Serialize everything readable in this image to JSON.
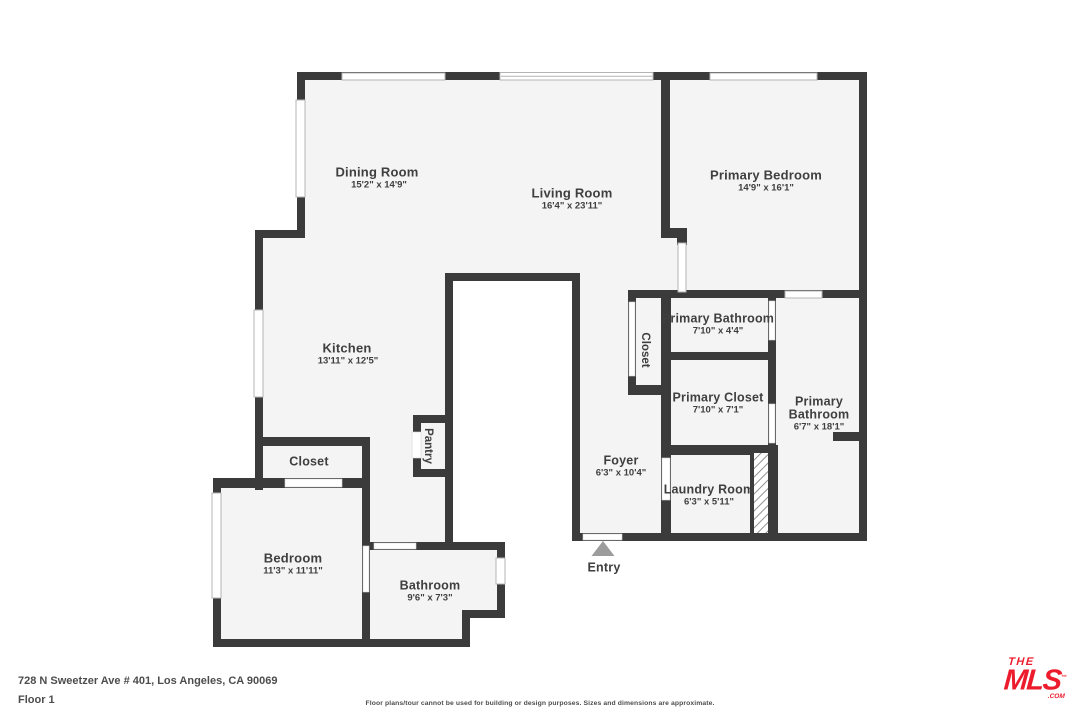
{
  "colors": {
    "wall": "#3b3b3b",
    "floor": "#f4f4f4",
    "label": "#3f3f3f",
    "logo_red": "#ec1c2d"
  },
  "rooms": {
    "dining": {
      "name": "Dining Room",
      "dims": "15'2\" x 14'9\""
    },
    "living": {
      "name": "Living Room",
      "dims": "16'4\" x 23'11\""
    },
    "primary_bedroom": {
      "name": "Primary Bedroom",
      "dims": "14'9\" x 16'1\""
    },
    "kitchen": {
      "name": "Kitchen",
      "dims": "13'11\" x 12'5\""
    },
    "primary_bathroom": {
      "name": "Primary Bathroom",
      "dims": "7'10\" x 4'4\""
    },
    "primary_closet": {
      "name": "Primary Closet",
      "dims": "7'10\" x 7'1\""
    },
    "primary_bathroom_2": {
      "name_line1": "Primary",
      "name_line2": "Bathroom",
      "dims": "6'7\" x 18'1\""
    },
    "foyer": {
      "name": "Foyer",
      "dims": "6'3\" x 10'4\""
    },
    "laundry": {
      "name": "Laundry Room",
      "dims": "6'3\" x 5'11\""
    },
    "closet_hall": {
      "name": "Closet"
    },
    "pantry": {
      "name": "Pantry"
    },
    "closet_bedroom": {
      "name": "Closet"
    },
    "bedroom": {
      "name": "Bedroom",
      "dims": "11'3\" x 11'11\""
    },
    "bathroom": {
      "name": "Bathroom",
      "dims": "9'6\" x 7'3\""
    }
  },
  "entry_label": "Entry",
  "footer": {
    "address": "728 N Sweetzer Ave # 401, Los Angeles, CA 90069",
    "floor": "Floor 1",
    "disclaimer": "Floor plans/tour cannot be used for building or design purposes. Sizes and dimensions are approximate."
  },
  "logo": {
    "the": "THE",
    "mls": "MLS",
    "tm": "™",
    "com": ".COM"
  }
}
